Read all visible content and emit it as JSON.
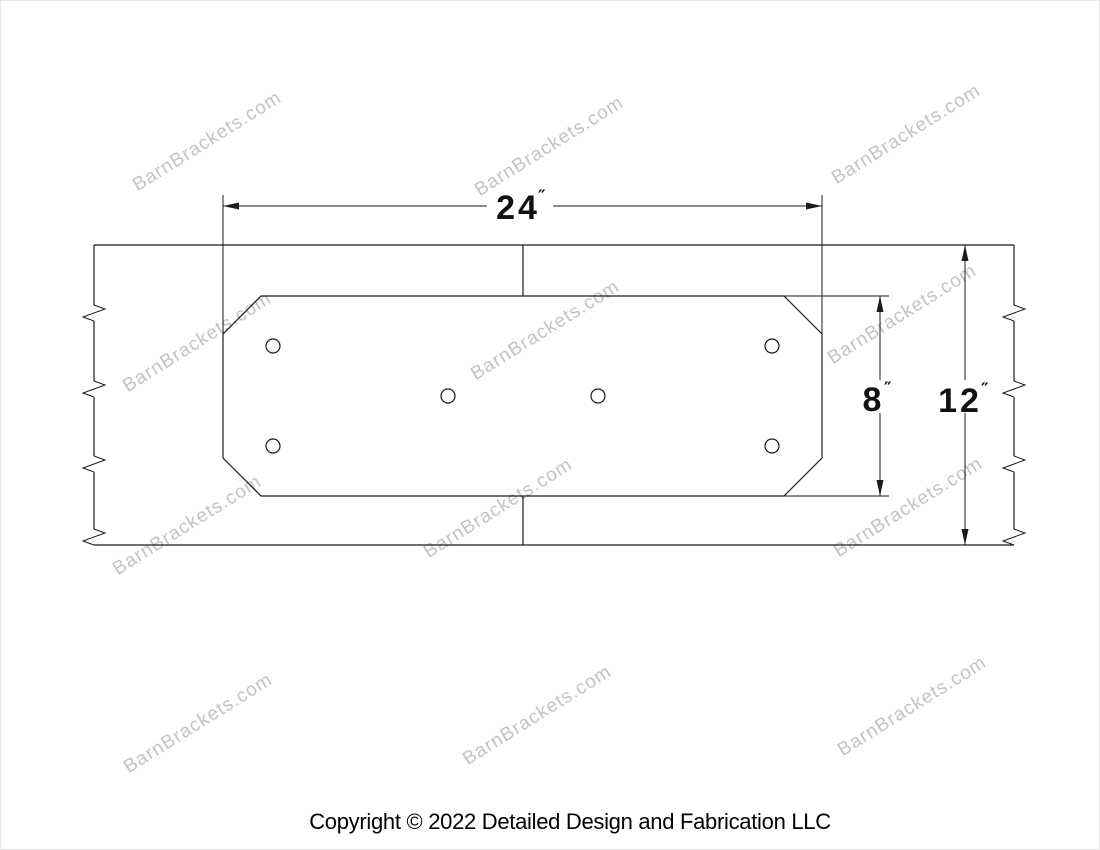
{
  "watermark": {
    "text": "BarnBrackets.com",
    "color": "#c3c3c3"
  },
  "dimensions": {
    "plate_width": {
      "value": "24",
      "unit": "″"
    },
    "plate_height": {
      "value": "8",
      "unit": "″"
    },
    "beam_height": {
      "value": "12",
      "unit": "″"
    }
  },
  "drawing": {
    "bolt_hole_count": 6
  },
  "footer": {
    "copyright": "Copyright © 2022 Detailed Design and Fabrication LLC"
  },
  "colors": {
    "line": "#1b1b1b",
    "dimension_text": "#111111",
    "watermark": "#c3c3c3",
    "background": "#ffffff"
  }
}
